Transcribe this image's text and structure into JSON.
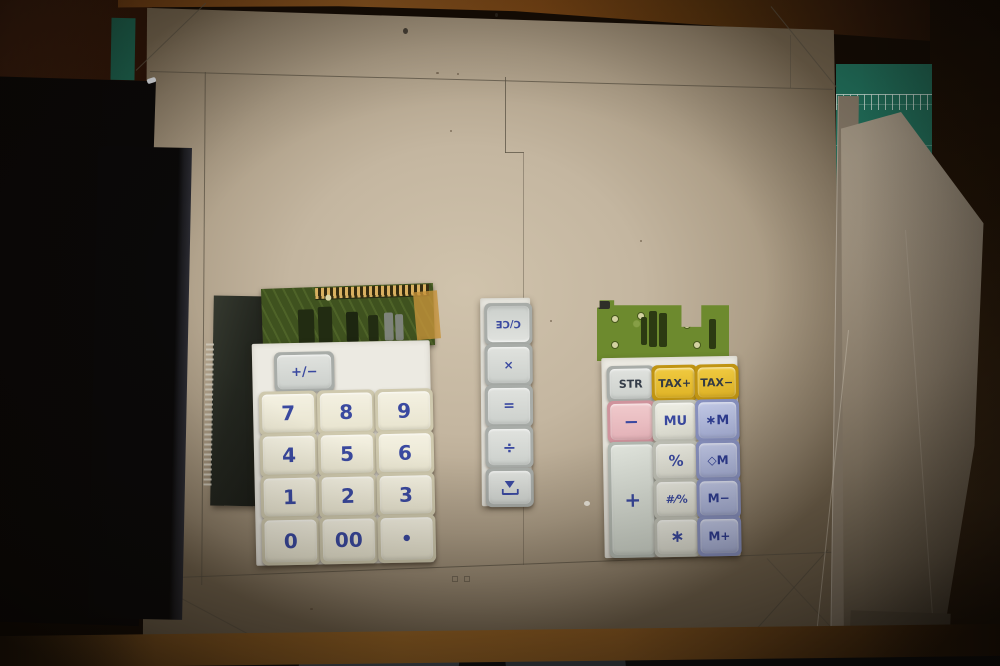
{
  "left_keypad": {
    "sign_key_label": "+/−",
    "key_rows": [
      [
        "7",
        "8",
        "9"
      ],
      [
        "4",
        "5",
        "6"
      ],
      [
        "1",
        "2",
        "3"
      ],
      [
        "0",
        "00",
        "•"
      ]
    ]
  },
  "center_key_strip": {
    "key_labels": [
      "C/CE",
      "×",
      "=",
      "÷"
    ],
    "feed_icon": "paper-feed-icon"
  },
  "right_keypad": {
    "row1": [
      "STR",
      "TAX+",
      "TAX−"
    ],
    "row2": [
      "−",
      "MU",
      "∗M"
    ],
    "plus_key_label": "+",
    "middle_column": [
      "%",
      "#⁄%",
      "∗"
    ],
    "memory_column": [
      "◇M",
      "M−",
      "M+"
    ]
  },
  "colors": {
    "cardboard": "#c4b6a0",
    "cutting_mat_green": "#237a64",
    "key_text_blue": "#3a49a0",
    "tax_key_yellow": "#e8c23a",
    "minus_key_pink": "#e6b8bc",
    "memory_key_lavender": "#aeb7dc",
    "pcb_green_left": "#3f521f",
    "pcb_green_right": "#6d8a2e",
    "wood_brown": "#8a5a22"
  }
}
